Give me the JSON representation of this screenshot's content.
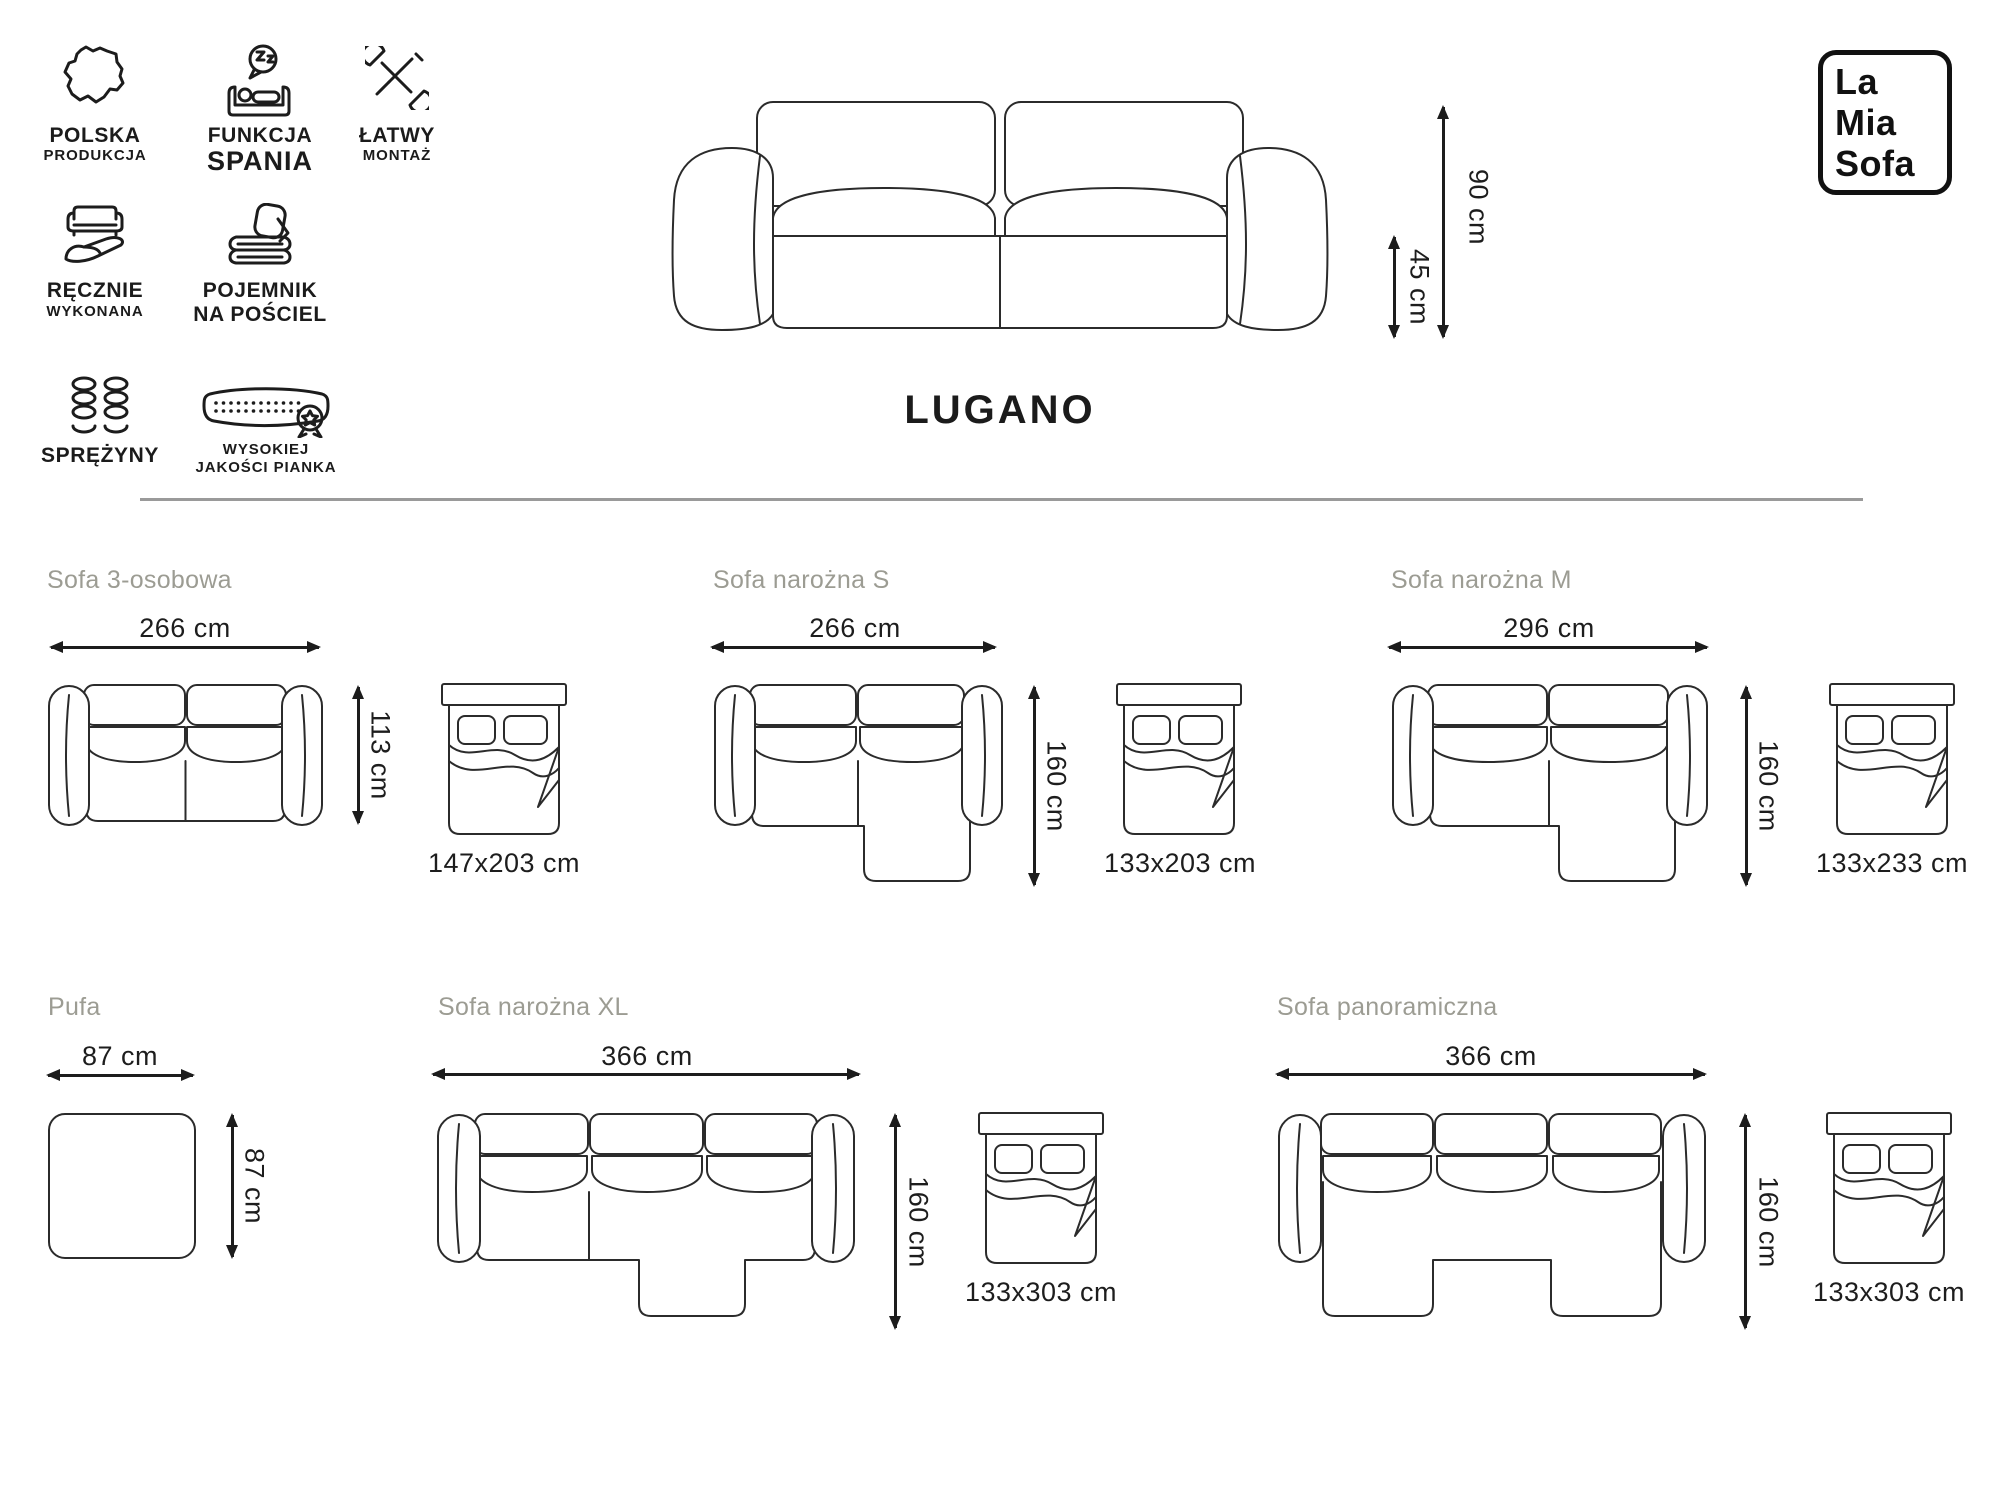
{
  "title": "LUGANO",
  "brand": {
    "line1": "La",
    "line2": "Mia",
    "line3": "Sofa"
  },
  "main_sofa": {
    "height": "90 cm",
    "seat_height": "45 cm"
  },
  "colors": {
    "line_art": "#2b2b2b",
    "text": "#1c1c1c",
    "variant_label": "#9c9c93",
    "divider": "#9a9a9a"
  },
  "features": [
    {
      "icon": "poland-map-icon",
      "line1": "POLSKA",
      "line2": "PRODUKCJA"
    },
    {
      "icon": "sleep-function-icon",
      "line1": "FUNKCJA",
      "line2": "SPANIA"
    },
    {
      "icon": "easy-assembly-tools-icon",
      "line1": "ŁATWY",
      "line2": "MONTAŻ"
    },
    {
      "icon": "handmade-icon",
      "line1": "RĘCZNIE",
      "line2": "WYKONANA"
    },
    {
      "icon": "bedding-storage-icon",
      "line1": "POJEMNIK",
      "line2": "NA POŚCIEL"
    },
    {
      "icon": "springs-icon",
      "line1": "SPRĘŻYNY",
      "line2": ""
    },
    {
      "icon": "foam-quality-icon",
      "line1": "WYSOKIEJ",
      "line2": "JAKOŚCI PIANKA"
    }
  ],
  "variants": [
    {
      "name": "Sofa 3-osobowa",
      "width": "266 cm",
      "depth": "113 cm",
      "bed": "147x203 cm"
    },
    {
      "name": "Sofa narożna S",
      "width": "266 cm",
      "depth": "160 cm",
      "bed": "133x203 cm"
    },
    {
      "name": "Sofa narożna M",
      "width": "296 cm",
      "depth": "160 cm",
      "bed": "133x233 cm"
    },
    {
      "name": "Pufa",
      "width": "87 cm",
      "depth": "87 cm",
      "bed": ""
    },
    {
      "name": "Sofa narożna XL",
      "width": "366 cm",
      "depth": "160 cm",
      "bed": "133x303 cm"
    },
    {
      "name": "Sofa panoramiczna",
      "width": "366 cm",
      "depth": "160 cm",
      "bed": "133x303 cm"
    }
  ]
}
